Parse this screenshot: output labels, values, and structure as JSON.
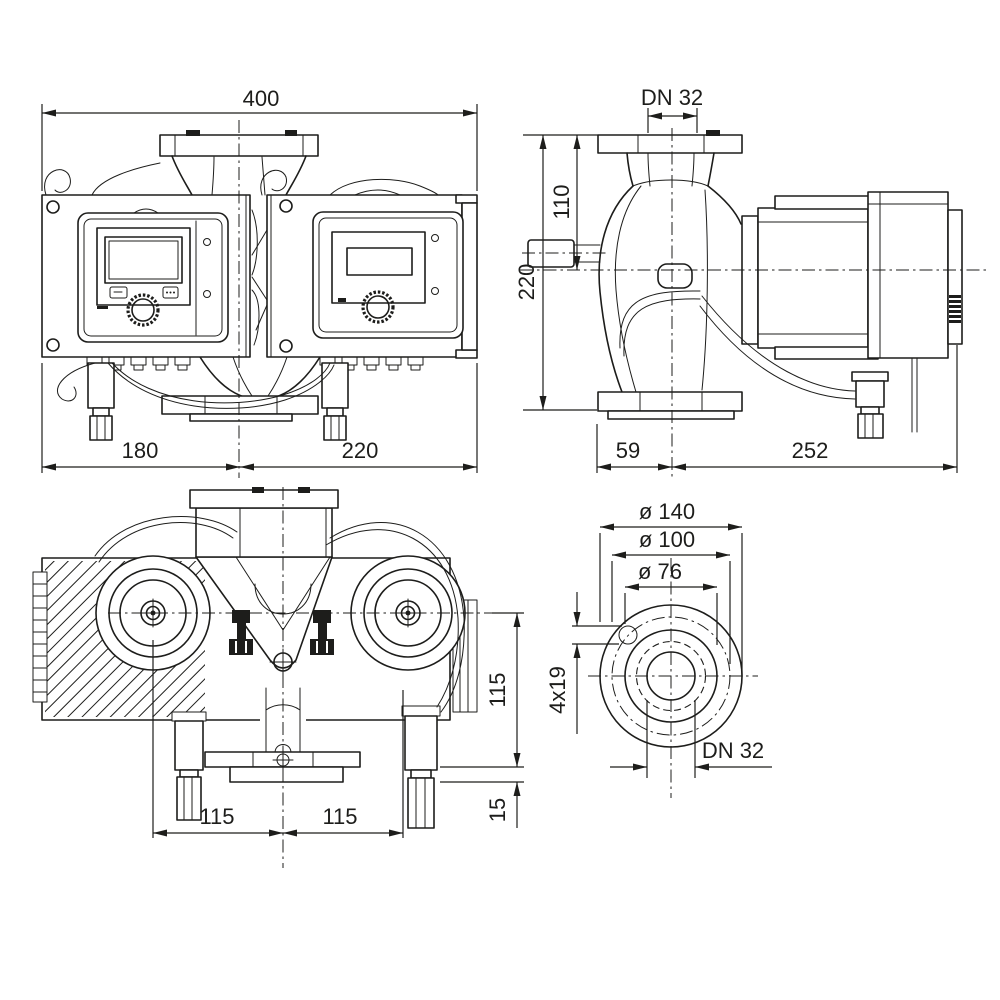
{
  "colors": {
    "line": "#1d1d1b",
    "background": "#ffffff"
  },
  "views": {
    "front": {
      "dims": {
        "total_width": "400",
        "left_width": "180",
        "right_width": "220"
      }
    },
    "side": {
      "dims": {
        "nominal": "DN 32",
        "port_height": "110",
        "total_height": "220",
        "front_depth": "59",
        "rear_depth": "252"
      }
    },
    "top": {
      "dims": {
        "left_offset": "115",
        "right_offset": "115",
        "axis_depth": "115",
        "flange_offset": "15"
      }
    },
    "flange": {
      "dims": {
        "outer_diameter": "ø 140",
        "bolt_circle": "ø 100",
        "raised_face": "ø 76",
        "bolt_holes": "4x19",
        "nominal": "DN 32"
      }
    }
  }
}
